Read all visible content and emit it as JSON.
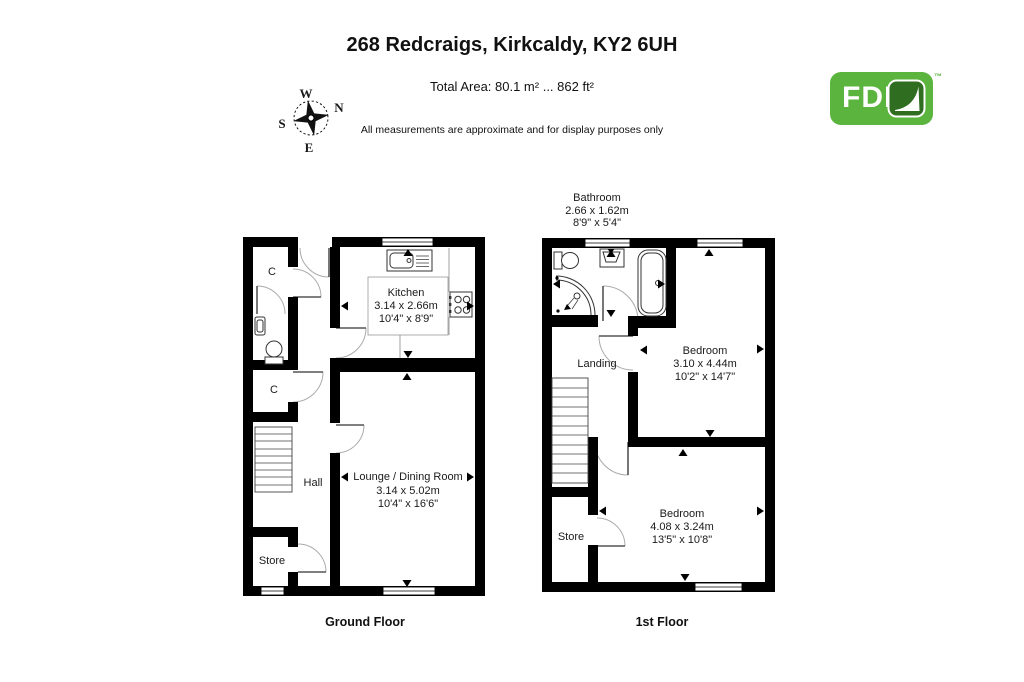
{
  "header": {
    "title": "268 Redcraigs, Kirkcaldy, KY2 6UH",
    "total_area": "Total Area: 80.1 m² ... 862 ft²",
    "disclaimer": "All measurements are approximate and for display purposes only"
  },
  "compass": {
    "top": "W",
    "right": "N",
    "left": "S",
    "bottom": "E"
  },
  "logo": {
    "text": "FDL",
    "tm": "™",
    "green": "#5bb43d",
    "leaf_green": "#2f6d20"
  },
  "ground_floor": {
    "caption": "Ground Floor",
    "kitchen": {
      "name": "Kitchen",
      "m": "3.14 x 2.66m",
      "ft": "10'4\" x 8'9\""
    },
    "lounge": {
      "name": "Lounge / Dining Room",
      "m": "3.14 x 5.02m",
      "ft": "10'4\" x 16'6\""
    },
    "hall": "Hall",
    "store": "Store",
    "closet1": "C",
    "closet2": "C"
  },
  "first_floor": {
    "caption": "1st Floor",
    "bathroom": {
      "name": "Bathroom",
      "m": "2.66 x 1.62m",
      "ft": "8'9\" x 5'4\""
    },
    "bedroom1": {
      "name": "Bedroom",
      "m": "3.10 x 4.44m",
      "ft": "10'2\" x 14'7\""
    },
    "bedroom2": {
      "name": "Bedroom",
      "m": "4.08 x 3.24m",
      "ft": "13'5\" x 10'8\""
    },
    "landing": "Landing",
    "store": "Store"
  }
}
